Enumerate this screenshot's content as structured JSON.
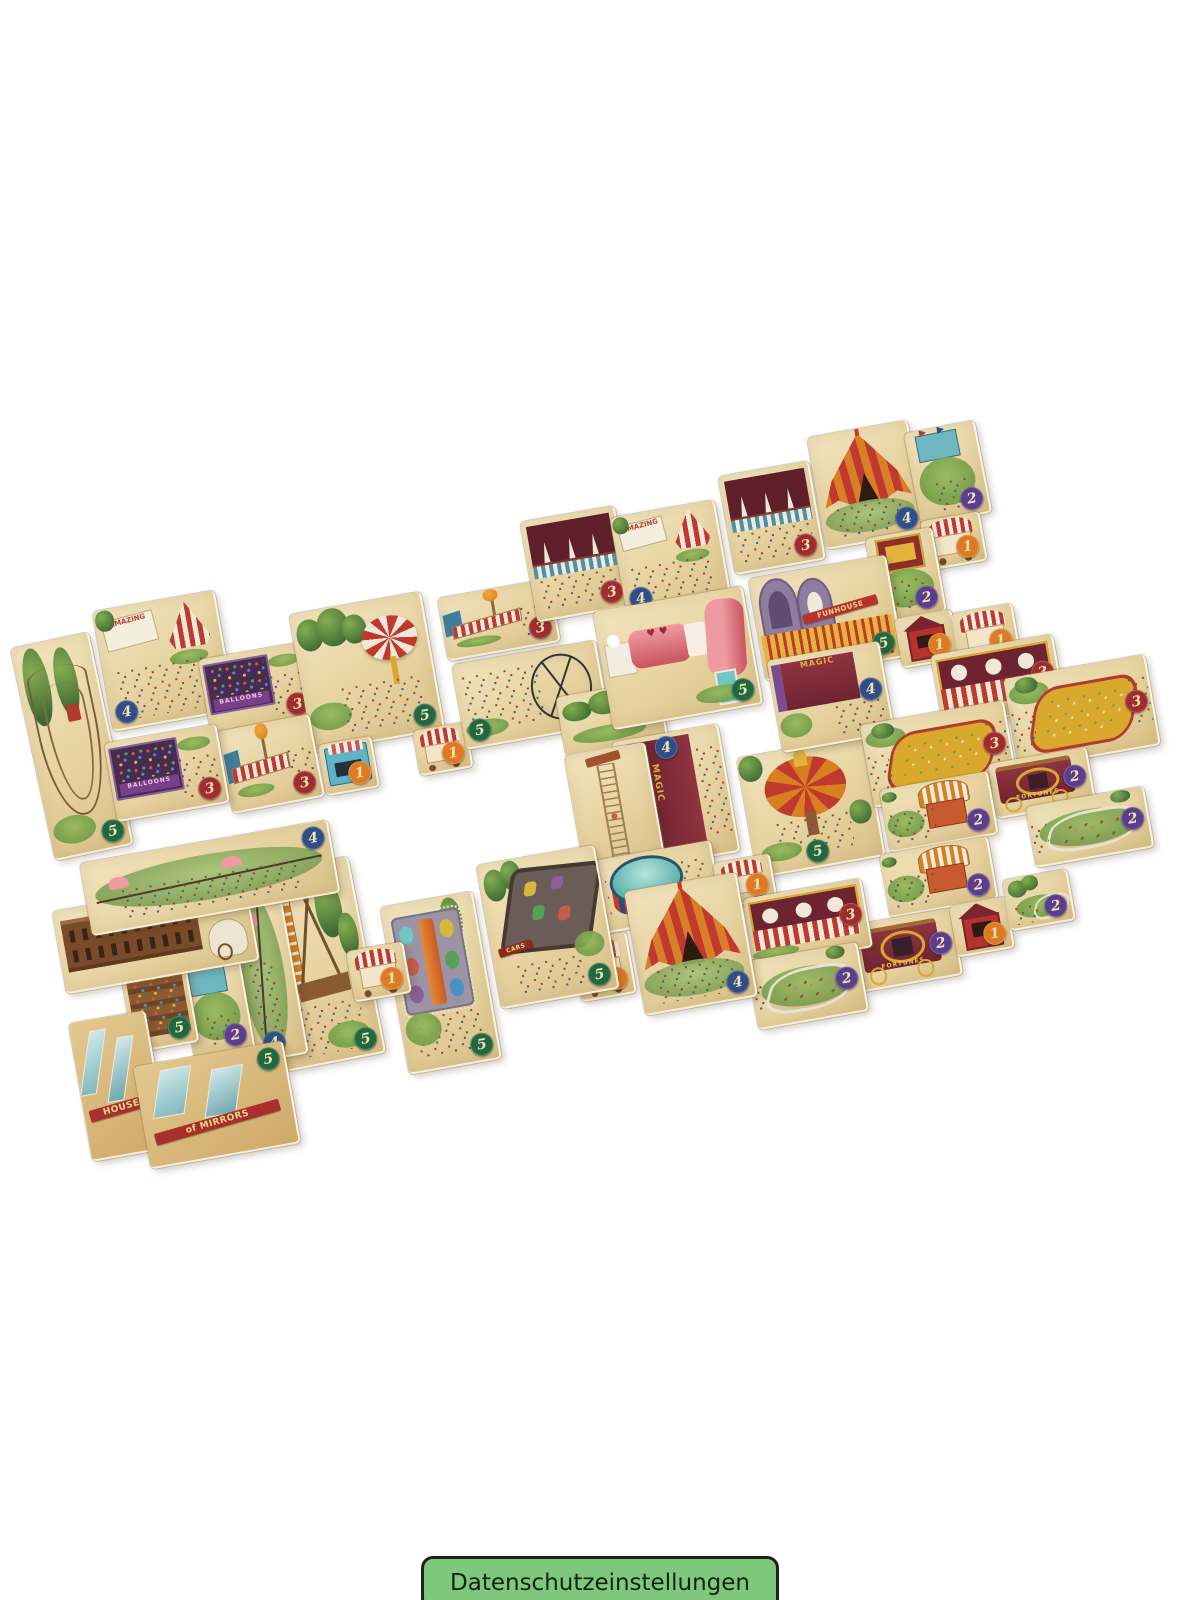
{
  "page": {
    "width": 1200,
    "height": 1600,
    "background": "#ffffff"
  },
  "consent_button": {
    "label": "Datenschutzeinstellungen",
    "bg": "#7ec87b",
    "border": "#1f1f1d",
    "text_color": "#142012"
  },
  "product_photo": {
    "description": "Scattered beige polyomino tiles of a carnival board game, rotated ~-10deg, each with carnival art and a numbered value badge",
    "tile_base_color": "#e8d6a7",
    "badge_text_color": "#f3e3b2",
    "badge_colors": {
      "1": "#dd7a22",
      "2": "#5b3d8f",
      "3": "#a02c30",
      "4": "#2f4e88",
      "5": "#20683f"
    },
    "tiles": [
      {
        "name": "tile-roller-coaster",
        "x": 32,
        "y": 638,
        "w": 78,
        "h": 215,
        "rot": -12,
        "motif": "coaster",
        "badge": "5",
        "pos": "br"
      },
      {
        "name": "tile-amazing-show-a",
        "x": 102,
        "y": 600,
        "w": 122,
        "h": 120,
        "rot": -10,
        "motif": "sign-tent",
        "badge": "4",
        "pos": "bl",
        "label": "AMAZING"
      },
      {
        "name": "tile-balloon-darts-a",
        "x": 204,
        "y": 650,
        "w": 106,
        "h": 76,
        "rot": -10,
        "motif": "balloons",
        "badge": "3",
        "pos": "br",
        "label": "BALLOONS"
      },
      {
        "name": "tile-umbrella-grove",
        "x": 300,
        "y": 602,
        "w": 132,
        "h": 138,
        "rot": -10,
        "motif": "umbrella-trees",
        "badge": "5",
        "pos": "br"
      },
      {
        "name": "tile-balloon-fence-a",
        "x": 224,
        "y": 722,
        "w": 92,
        "h": 82,
        "rot": -11,
        "motif": "balloon-fence",
        "badge": "3",
        "pos": "br"
      },
      {
        "name": "tile-balloon-darts-b",
        "x": 110,
        "y": 733,
        "w": 112,
        "h": 78,
        "rot": -10,
        "motif": "balloons",
        "badge": "3",
        "pos": "br",
        "label": "BALLOONS"
      },
      {
        "name": "tile-snack-bar",
        "x": 322,
        "y": 740,
        "w": 52,
        "h": 50,
        "rot": -10,
        "motif": "booth-blue",
        "badge": "1",
        "pos": "br"
      },
      {
        "name": "tile-candy-shop-a",
        "x": 416,
        "y": 726,
        "w": 52,
        "h": 44,
        "rot": -10,
        "motif": "cart-awning",
        "badge": "1",
        "pos": "br"
      },
      {
        "name": "tile-balloon-fence-b",
        "x": 442,
        "y": 588,
        "w": 112,
        "h": 62,
        "rot": -10,
        "motif": "balloon-fence",
        "badge": "3",
        "pos": "br"
      },
      {
        "name": "tile-cage-ride-crowd",
        "x": 458,
        "y": 652,
        "w": 144,
        "h": 84,
        "rot": -10,
        "motif": "cage-crowd",
        "badge": "5",
        "pos": "bl"
      },
      {
        "name": "tile-pine-trees",
        "x": 560,
        "y": 688,
        "w": 102,
        "h": 58,
        "rot": -10,
        "motif": "trees"
      },
      {
        "name": "tile-juggling-booth-a",
        "x": 528,
        "y": 513,
        "w": 94,
        "h": 100,
        "rot": -10,
        "motif": "juggle",
        "badge": "3",
        "pos": "br"
      },
      {
        "name": "tile-amazing-show-b",
        "x": 618,
        "y": 508,
        "w": 104,
        "h": 100,
        "rot": -10,
        "motif": "sign-tent",
        "badge": "4",
        "pos": "bl",
        "label": "AMAZING"
      },
      {
        "name": "tile-juggling-booth-b",
        "x": 726,
        "y": 468,
        "w": 90,
        "h": 98,
        "rot": -10,
        "motif": "juggle",
        "badge": "3",
        "pos": "br"
      },
      {
        "name": "tile-big-top-a",
        "x": 816,
        "y": 428,
        "w": 100,
        "h": 112,
        "rot": -10,
        "motif": "tent-big",
        "badge": "4",
        "pos": "br"
      },
      {
        "name": "tile-flag-stand-a",
        "x": 912,
        "y": 426,
        "w": 70,
        "h": 92,
        "rot": -11,
        "motif": "stand-flags",
        "badge": "2",
        "pos": "br"
      },
      {
        "name": "tile-candy-stand",
        "x": 924,
        "y": 516,
        "w": 58,
        "h": 48,
        "rot": -10,
        "motif": "cart-awning",
        "badge": "1",
        "pos": "br"
      },
      {
        "name": "tile-puppet-show",
        "x": 872,
        "y": 532,
        "w": 66,
        "h": 84,
        "rot": -10,
        "motif": "puppet",
        "badge": "2",
        "pos": "br"
      },
      {
        "name": "tile-funhouse",
        "x": 756,
        "y": 566,
        "w": 138,
        "h": 102,
        "rot": -10,
        "motif": "funhouse",
        "badge": "5",
        "pos": "br",
        "label": "FUNHOUSE"
      },
      {
        "name": "tile-tunnel-of-love",
        "x": 602,
        "y": 598,
        "w": 150,
        "h": 118,
        "rot": -10,
        "motif": "tunnel",
        "badge": "5",
        "pos": "br"
      },
      {
        "name": "tile-magic-stage-a",
        "x": 622,
        "y": 732,
        "w": 106,
        "h": 128,
        "rot": -10,
        "motif": "magic",
        "badge": "4",
        "pos": "tc",
        "label": "MAGIC"
      },
      {
        "name": "tile-high-dive-tower",
        "x": 574,
        "y": 748,
        "w": 80,
        "h": 118,
        "rot": -10,
        "motif": "tower"
      },
      {
        "name": "tile-high-dive-pool",
        "x": 574,
        "y": 852,
        "w": 142,
        "h": 72,
        "rot": -10,
        "motif": "pool",
        "badge": "5",
        "pos": "br"
      },
      {
        "name": "tile-carousel",
        "x": 746,
        "y": 746,
        "w": 128,
        "h": 120,
        "rot": -10,
        "motif": "carousel",
        "badge": "5",
        "pos": "bc"
      },
      {
        "name": "tile-food-cart-b",
        "x": 716,
        "y": 858,
        "w": 56,
        "h": 44,
        "rot": -10,
        "motif": "cart-awning",
        "badge": "1",
        "pos": "br"
      },
      {
        "name": "tile-magic-stage-b",
        "x": 774,
        "y": 650,
        "w": 112,
        "h": 92,
        "rot": -10,
        "motif": "magic-h",
        "badge": "4",
        "pos": "rc",
        "label": "MAGIC"
      },
      {
        "name": "tile-ticket-booth-a",
        "x": 898,
        "y": 614,
        "w": 56,
        "h": 48,
        "rot": -10,
        "motif": "ticket",
        "badge": "1",
        "pos": "br"
      },
      {
        "name": "tile-popcorn-cart",
        "x": 955,
        "y": 608,
        "w": 60,
        "h": 50,
        "rot": -10,
        "motif": "cart-awning",
        "badge": "1",
        "pos": "br"
      },
      {
        "name": "tile-clown-game-a",
        "x": 936,
        "y": 644,
        "w": 122,
        "h": 72,
        "rot": -10,
        "motif": "clown-booth",
        "badge": "3",
        "pos": "rc"
      },
      {
        "name": "tile-duck-pond-a",
        "x": 1010,
        "y": 666,
        "w": 142,
        "h": 90,
        "rot": -10,
        "motif": "pond",
        "badge": "3",
        "pos": "rc"
      },
      {
        "name": "tile-duck-pond-b",
        "x": 866,
        "y": 712,
        "w": 144,
        "h": 82,
        "rot": -10,
        "motif": "pond",
        "badge": "3",
        "pos": "rc"
      },
      {
        "name": "tile-fortunes-wagon-a",
        "x": 992,
        "y": 755,
        "w": 98,
        "h": 54,
        "rot": -10,
        "motif": "fortunes",
        "badge": "2",
        "pos": "rc",
        "label": "FORTUNES"
      },
      {
        "name": "tile-strongman-booth-a",
        "x": 884,
        "y": 780,
        "w": 108,
        "h": 62,
        "rot": -10,
        "motif": "strongman",
        "badge": "2",
        "pos": "br"
      },
      {
        "name": "tile-pony-pen-a",
        "x": 1030,
        "y": 796,
        "w": 118,
        "h": 60,
        "rot": -10,
        "motif": "pen",
        "badge": "2",
        "pos": "rc"
      },
      {
        "name": "tile-strongman-booth-b",
        "x": 884,
        "y": 845,
        "w": 108,
        "h": 62,
        "rot": -10,
        "motif": "strongman",
        "badge": "2",
        "pos": "br"
      },
      {
        "name": "tile-fortunes-wagon-b",
        "x": 856,
        "y": 916,
        "w": 100,
        "h": 66,
        "rot": -10,
        "motif": "fortunes",
        "badge": "2",
        "pos": "rc",
        "label": "FORTUNES"
      },
      {
        "name": "tile-ticket-booth-b",
        "x": 953,
        "y": 901,
        "w": 56,
        "h": 50,
        "rot": -10,
        "motif": "ticket",
        "badge": "1",
        "pos": "br"
      },
      {
        "name": "tile-pen-trees",
        "x": 1006,
        "y": 874,
        "w": 64,
        "h": 50,
        "rot": -10,
        "motif": "pen-trees",
        "badge": "2",
        "pos": "br"
      },
      {
        "name": "tile-clown-game-b",
        "x": 748,
        "y": 888,
        "w": 118,
        "h": 68,
        "rot": -10,
        "motif": "clown-booth",
        "badge": "3",
        "pos": "rc"
      },
      {
        "name": "tile-pony-ring",
        "x": 752,
        "y": 951,
        "w": 110,
        "h": 68,
        "rot": -10,
        "motif": "pen",
        "badge": "2",
        "pos": "rc"
      },
      {
        "name": "tile-big-top-b",
        "x": 634,
        "y": 881,
        "w": 112,
        "h": 124,
        "rot": -10,
        "motif": "tent-big",
        "badge": "4",
        "pos": "br"
      },
      {
        "name": "tile-mini-tent-cart",
        "x": 576,
        "y": 936,
        "w": 54,
        "h": 60,
        "rot": -10,
        "motif": "cart-awning",
        "badge": "1",
        "pos": "br"
      },
      {
        "name": "tile-dodgem-cars",
        "x": 488,
        "y": 854,
        "w": 118,
        "h": 144,
        "rot": -10,
        "motif": "cars",
        "badge": "5",
        "pos": "br",
        "label": "CARS"
      },
      {
        "name": "tile-teacup-ride",
        "x": 394,
        "y": 898,
        "w": 92,
        "h": 168,
        "rot": -10,
        "motif": "teacup",
        "badge": "5",
        "pos": "br"
      },
      {
        "name": "tile-swing-ride",
        "x": 266,
        "y": 864,
        "w": 100,
        "h": 198,
        "rot": -11,
        "motif": "swingride",
        "badge": "5",
        "pos": "br"
      },
      {
        "name": "tile-candy-shop-b",
        "x": 350,
        "y": 946,
        "w": 56,
        "h": 50,
        "rot": -10,
        "motif": "cart-awning",
        "badge": "1",
        "pos": "br"
      },
      {
        "name": "tile-tightrope-walker",
        "x": 232,
        "y": 884,
        "w": 60,
        "h": 174,
        "rot": -10,
        "motif": "tightrope-v",
        "badge": "4",
        "pos": "bc"
      },
      {
        "name": "tile-flag-stand-b",
        "x": 186,
        "y": 961,
        "w": 60,
        "h": 92,
        "rot": -10,
        "motif": "stand-flags",
        "badge": "2",
        "pos": "br"
      },
      {
        "name": "tile-grandstand",
        "x": 126,
        "y": 956,
        "w": 64,
        "h": 90,
        "rot": -10,
        "motif": "grandstand",
        "badge": "5",
        "pos": "br"
      },
      {
        "name": "tile-saloon-wagon",
        "x": 58,
        "y": 894,
        "w": 194,
        "h": 82,
        "rot": -10,
        "motif": "saloon"
      },
      {
        "name": "tile-slackline",
        "x": 84,
        "y": 841,
        "w": 250,
        "h": 72,
        "rot": -10,
        "motif": "tightrope-h",
        "badge": "4",
        "pos": "tr"
      },
      {
        "name": "tile-house-of-mirrors-a",
        "x": 80,
        "y": 1016,
        "w": 76,
        "h": 138,
        "rot": -10,
        "motif": "mirrors",
        "label": "HOUSE"
      },
      {
        "name": "tile-house-of-mirrors-b",
        "x": 141,
        "y": 1053,
        "w": 150,
        "h": 102,
        "rot": -10,
        "motif": "mirrors",
        "badge": "5",
        "pos": "tr",
        "label": "of MIRRORS"
      }
    ]
  }
}
